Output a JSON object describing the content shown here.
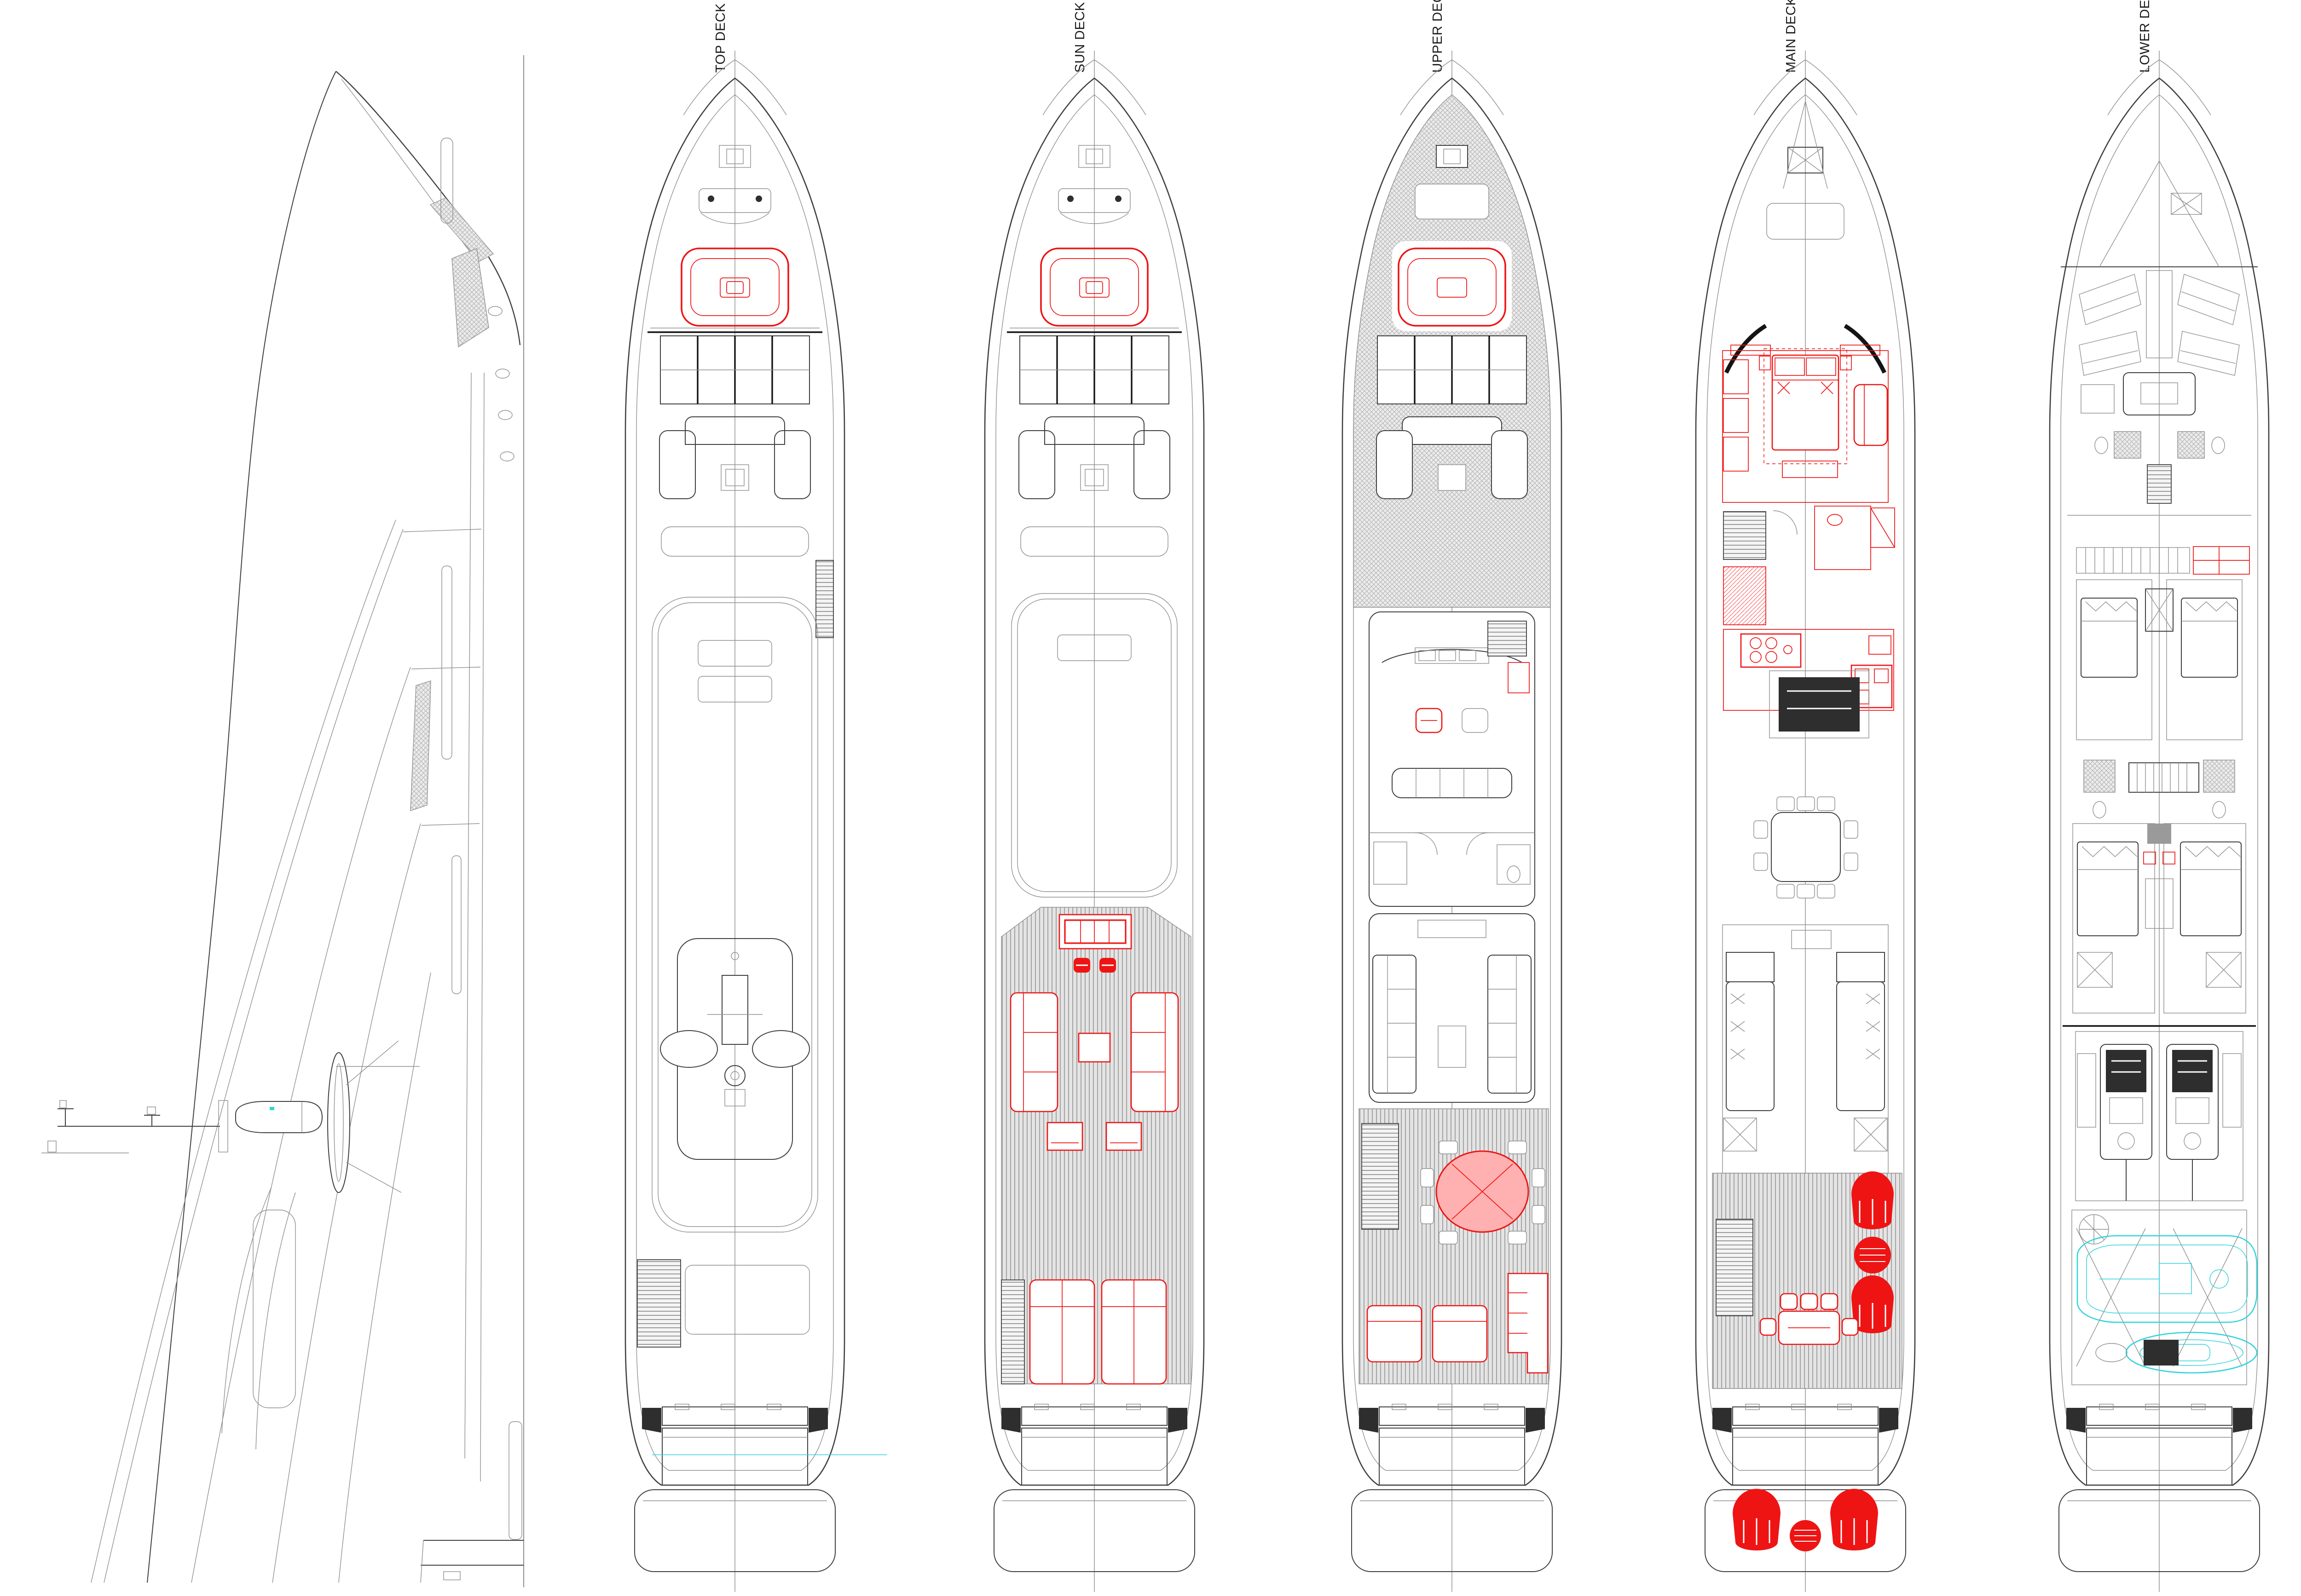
{
  "drawing": {
    "type": "yacht-general-arrangement",
    "views": [
      "side-profile",
      "top-deck-plan",
      "sun-deck-plan",
      "upper-deck-plan",
      "main-deck-plan",
      "lower-deck-plan"
    ]
  },
  "decks": [
    {
      "id": "top",
      "label": "TOP DECK"
    },
    {
      "id": "sun",
      "label": "SUN DECK"
    },
    {
      "id": "upper",
      "label": "UPPER DECK"
    },
    {
      "id": "main",
      "label": "MAIN DECK"
    },
    {
      "id": "lower",
      "label": "LOWER DECK"
    }
  ],
  "colors": {
    "bg": "#ffffff",
    "label_color": "#1b1b1b",
    "line": "#3f3f3f",
    "line_dark": "#141414",
    "line_light": "#8f8f8f",
    "centerline": "#9a9a9a",
    "hl_red": "#ee1414",
    "hl_red_fill": "#ffb0b0",
    "hl_cyan": "#2fd4dc",
    "teak_bg": "#e4e4e4",
    "teak_stripe": "#a2a2a2",
    "hatch": "#b8b8b8",
    "dark_fill": "#2e2e2e"
  }
}
